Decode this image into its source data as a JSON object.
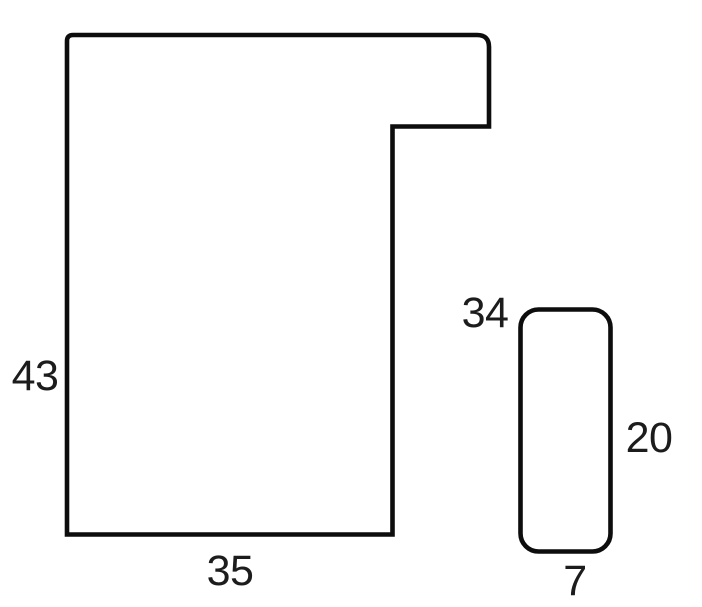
{
  "page": {
    "background_color": "#ffffff",
    "line_color": "#0d0d0d",
    "text_color": "#1c1c1c"
  },
  "diagram": {
    "large_profile": {
      "height_label": "43",
      "width_label": "35"
    },
    "small_profile": {
      "top_label": "34",
      "height_label": "20",
      "width_label": "7"
    }
  }
}
